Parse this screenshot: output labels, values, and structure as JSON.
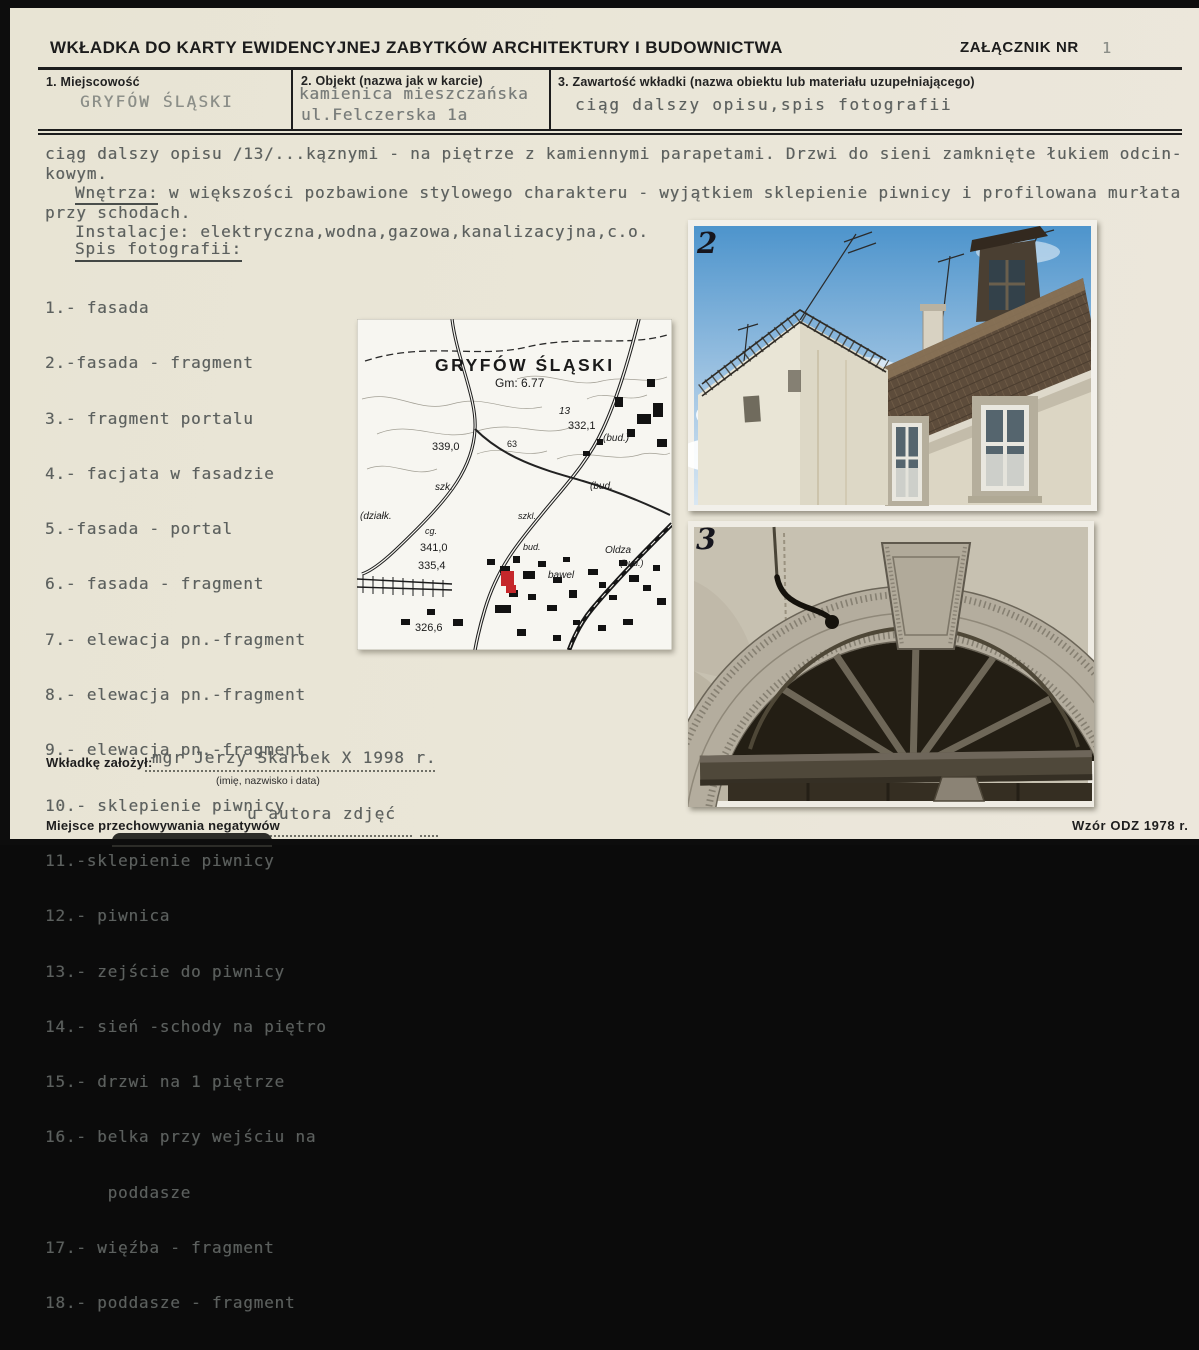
{
  "header": {
    "title": "WKŁADKA DO KARTY EWIDENCYJNEJ ZABYTKÓW ARCHITEKTURY I BUDOWNICTWA",
    "attachment_label": "ZAŁĄCZNIK NR",
    "attachment_number": "1"
  },
  "fields": {
    "place": {
      "label": "1. Miejscowość",
      "value": "GRYFÓW ŚLĄSKI"
    },
    "object": {
      "label": "2. Objekt (nazwa jak w karcie)",
      "value_line1": "kamienica mieszczańska",
      "value_line2": "ul.Felczerska 1a"
    },
    "contents": {
      "label": "3. Zawartość wkładki (nazwa obiektu lub materiału uzupełniającego)",
      "value": "ciąg dalszy opisu,spis fotografii"
    }
  },
  "description": {
    "line1": "ciąg dalszy opisu /13/...kąznymi - na piętrze z kamiennymi parapetami. Drzwi do sieni zamknięte łukiem odcin-",
    "line2": "kowym.",
    "wnetrza_label": "Wnętrza:",
    "wnetrza_rest": " w większości pozbawione stylowego charakteru - wyjątkiem sklepienie piwnicy i profilowana murłata",
    "line4": "przy schodach.",
    "line5": "Instalacje: elektryczna,wodna,gazowa,kanalizacyjna,c.o."
  },
  "photo_list": {
    "heading": "Spis fotografii:",
    "items": [
      "1.- fasada",
      "2.-fasada - fragment",
      "3.- fragment portalu",
      "4.- facjata w fasadzie",
      "5.-fasada - portal",
      "6.- fasada - fragment",
      "7.- elewacja pn.-fragment",
      "8.- elewacja pn.-fragment",
      "9.- elewacja pn.-fragment",
      "10.- sklepienie piwnicy",
      "11.-sklepienie piwnicy",
      "12.- piwnica",
      "13.- zejście do piwnicy",
      "14.- sień -schody na piętro",
      "15.- drzwi na 1 piętrze",
      "16.- belka przy wejściu na",
      "      poddasze",
      "17.- więźba - fragment",
      "18.- poddasze - fragment"
    ]
  },
  "map": {
    "title": "GRYFÓW ŚLĄSKI",
    "subtitle": "Gm: 6.77",
    "labels": [
      "13",
      "332,1",
      "(bud.)",
      "339,0",
      "63",
      "szk.",
      "(bud.",
      "(działk.",
      "szkl.",
      "cg.",
      "341,0",
      "bud.",
      "Oldza",
      "(bud.)",
      "335,4",
      "bawel",
      "326,6"
    ],
    "marker_color": "#c5272b"
  },
  "photos": [
    {
      "number": "2"
    },
    {
      "number": "3"
    }
  ],
  "footer": {
    "founder_label": "Wkładkę założył:",
    "founder_value": "mgr Jerzy Skarbek X 1998 r.",
    "founder_hint": "(imię, nazwisko i data)",
    "negatives_label": "Miejsce przechowywania negatywów",
    "negatives_value": "u autora zdjęć",
    "form_version": "Wzór ODZ 1978 r."
  },
  "colors": {
    "paper": "#e9e5d7",
    "ink": "#1c1c1c",
    "typewriter": "#5c605e",
    "map_marker": "#c5272b",
    "sky": "#4d94cc"
  }
}
